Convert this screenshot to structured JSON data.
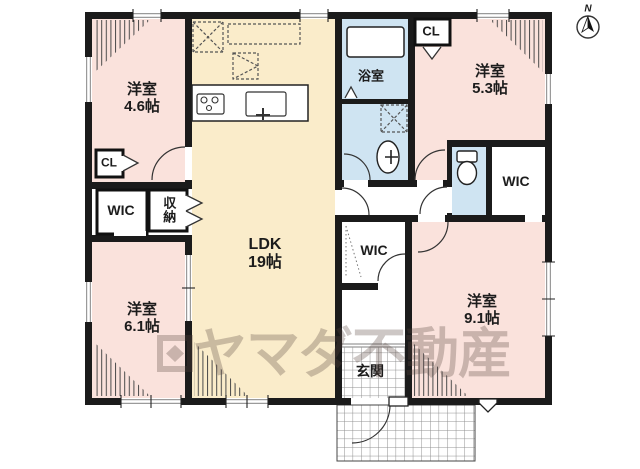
{
  "rooms": {
    "r46": {
      "label": "洋室",
      "size": "4.6帖"
    },
    "r53": {
      "label": "洋室",
      "size": "5.3帖"
    },
    "r61": {
      "label": "洋室",
      "size": "6.1帖"
    },
    "r91": {
      "label": "洋室",
      "size": "9.1帖"
    },
    "ldk": {
      "label": "LDK",
      "size": "19帖"
    },
    "bath": {
      "label": "浴室"
    },
    "entrance": {
      "label": "玄関"
    },
    "cl1": {
      "label": "CL"
    },
    "cl2": {
      "label": "CL"
    },
    "wic_left": {
      "label": "WIC"
    },
    "wic_mid": {
      "label": "WIC"
    },
    "wic_right": {
      "label": "WIC"
    },
    "storage": {
      "label": "収納"
    }
  },
  "compass": {
    "label": "N"
  },
  "watermark": {
    "text": "ヤマダ不動産"
  },
  "colors": {
    "wall": "#1b1b1b",
    "room-pink": "#fae2dc",
    "ldk-cream": "#faecca",
    "wet-blue": "#cfe4f2",
    "window-gray": "#9a9a9a",
    "line": "#333333",
    "watermark-color": "rgba(88,70,64,0.30)"
  }
}
